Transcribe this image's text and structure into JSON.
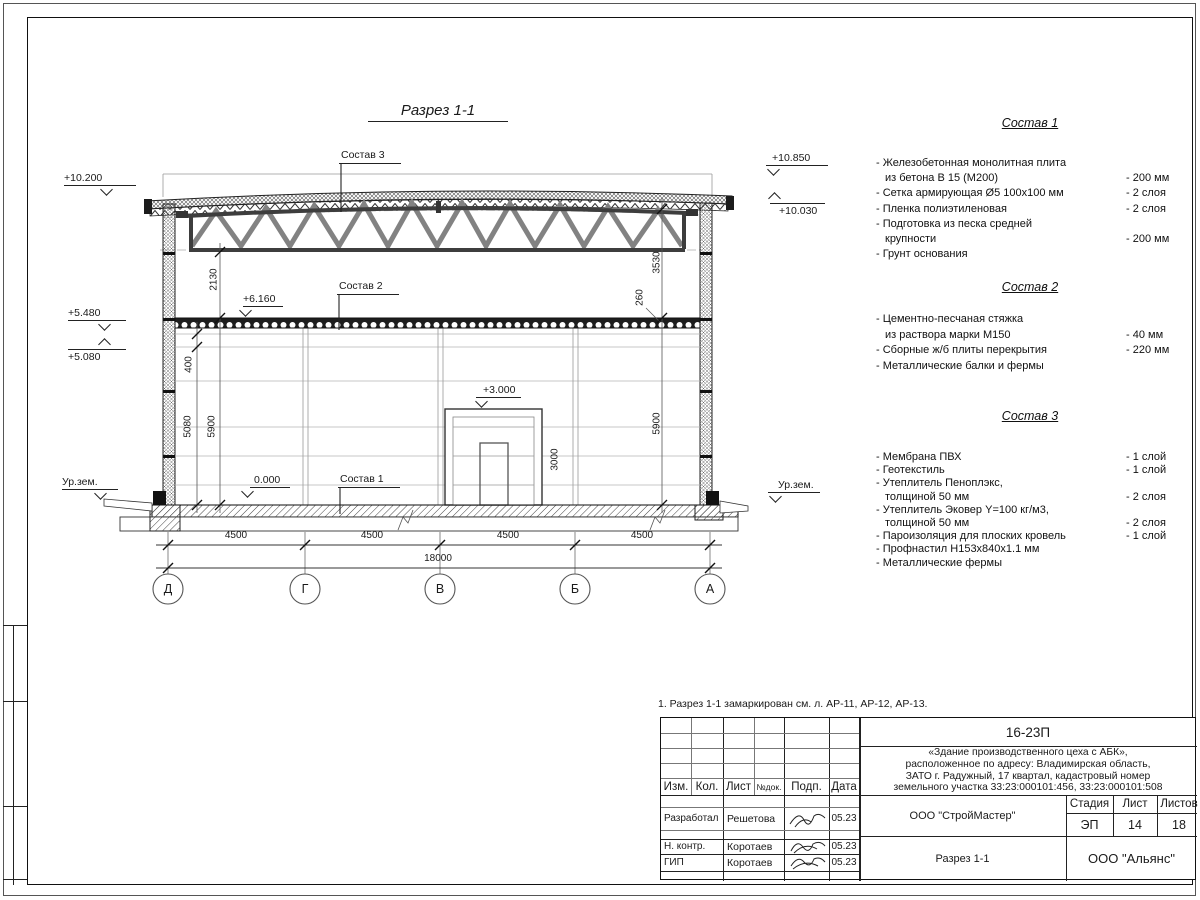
{
  "drawing": {
    "title": "Разрез 1-1",
    "labels": {
      "sostav1": "Состав 1",
      "sostav2": "Состав 2",
      "sostav3": "Состав 3"
    },
    "elevations": {
      "e10200": "+10.200",
      "e5480": "+5.480",
      "e5080": "+5.080",
      "e10850": "+10.850",
      "e10030": "+10.030",
      "e6160": "+6.160",
      "e3000": "+3.000",
      "e0000": "0.000",
      "ground_left": "Ур.зем.",
      "ground_right": "Ур.зем."
    },
    "dims": {
      "v2130": "2130",
      "v3530": "3530",
      "v260": "260",
      "v400": "400",
      "v5080": "5080",
      "v5900_left": "5900",
      "v5900_right": "5900",
      "v3000": "3000",
      "span1": "4500",
      "span2": "4500",
      "span3": "4500",
      "span4": "4500",
      "total": "18000"
    },
    "axes": [
      {
        "label": "Д"
      },
      {
        "label": "Г"
      },
      {
        "label": "В"
      },
      {
        "label": "Б"
      },
      {
        "label": "А"
      }
    ]
  },
  "compositions": [
    {
      "title": "Состав 1",
      "rows": [
        {
          "text": "- Железобетонная  монолитная плита",
          "value": ""
        },
        {
          "text": "из бетона В 15 (М200)",
          "value": "- 200 мм"
        },
        {
          "text": "- Сетка армирующая Ø5 100х100 мм",
          "value": "- 2 слоя"
        },
        {
          "text": "- Пленка полиэтиленовая",
          "value": "- 2 слоя"
        },
        {
          "text": "- Подготовка из песка средней",
          "value": ""
        },
        {
          "text": "крупности",
          "value": "- 200 мм"
        },
        {
          "text": "- Грунт основания",
          "value": ""
        }
      ]
    },
    {
      "title": "Состав 2",
      "rows": [
        {
          "text": "- Цементно-песчаная стяжка",
          "value": ""
        },
        {
          "text": "из раствора марки М150",
          "value": "- 40 мм"
        },
        {
          "text": "- Сборные ж/б плиты перекрытия",
          "value": "- 220 мм"
        },
        {
          "text": "- Металлические балки и фермы",
          "value": ""
        }
      ]
    },
    {
      "title": "Состав 3",
      "rows": [
        {
          "text": "- Мембрана ПВХ",
          "value": "- 1 слой"
        },
        {
          "text": "- Геотекстиль",
          "value": "- 1 слой"
        },
        {
          "text": "- Утеплитель Пеноплэкс,",
          "value": ""
        },
        {
          "text": "толщиной 50 мм",
          "value": "- 2 слоя"
        },
        {
          "text": "- Утеплитель Эковер Y=100 кг/м3,",
          "value": ""
        },
        {
          "text": "толщиной 50 мм",
          "value": "- 2 слоя"
        },
        {
          "text": "- Пароизоляция для плоских кровель",
          "value": "- 1 слой"
        },
        {
          "text": "- Профнастил Н153х840х1.1 мм",
          "value": ""
        },
        {
          "text": "- Металлические фермы",
          "value": ""
        }
      ]
    }
  ],
  "note": "1. Разрез 1-1 замаркирован см. л. АР-11, АР-12, АР-13.",
  "title_block": {
    "doc_number": "16-23П",
    "object_lines": [
      "«Здание производственного цеха с АБК»,",
      "расположенное по адресу: Владимирская область,",
      "ЗАТО г. Радужный, 17 квартал, кадастровый номер",
      "земельного участка 33:23:000101:456, 33:23:000101:508"
    ],
    "columns": {
      "izm": "Изм.",
      "kol": "Кол.",
      "list": "Лист",
      "ndok": "№док.",
      "podp": "Подп.",
      "data": "Дата"
    },
    "rows": [
      {
        "role": "Разработал",
        "name": "Решетова",
        "date": "05.23"
      },
      {
        "role": "Н. контр.",
        "name": "Коротаев",
        "date": "05.23"
      },
      {
        "role": "ГИП",
        "name": "Коротаев",
        "date": "05.23"
      }
    ],
    "org": "ООО \"СтройМастер\"",
    "stage_label": "Стадия",
    "sheet_label": "Лист",
    "sheets_label": "Листов",
    "stage": "ЭП",
    "sheet": "14",
    "sheets": "18",
    "section_name": "Разрез 1-1",
    "company": "ООО \"Альянс\""
  }
}
